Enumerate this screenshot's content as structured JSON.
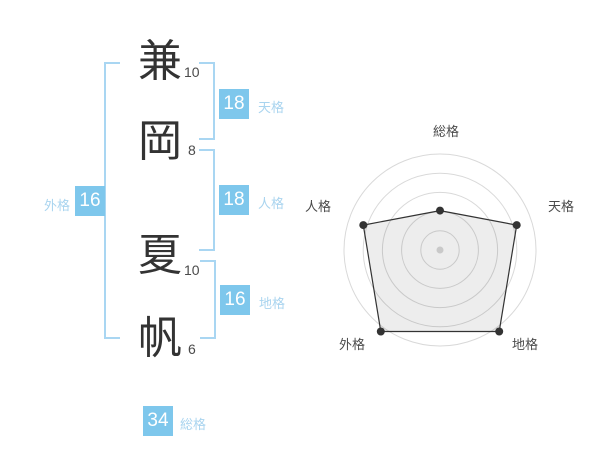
{
  "title": "姓名判断の画数と五格",
  "name": {
    "chars": [
      {
        "char": "兼",
        "strokes": "10"
      },
      {
        "char": "岡",
        "strokes": "8"
      },
      {
        "char": "夏",
        "strokes": "10"
      },
      {
        "char": "帆",
        "strokes": "6"
      }
    ]
  },
  "kaku": {
    "tenkaku": {
      "label": "天格",
      "value": "18"
    },
    "jinkaku": {
      "label": "人格",
      "value": "18"
    },
    "chikaku": {
      "label": "地格",
      "value": "16"
    },
    "gaikaku": {
      "label": "外格",
      "value": "16"
    },
    "soukaku": {
      "label": "総格",
      "value": "34"
    }
  },
  "colors": {
    "badge_blue": "#7ec7ec",
    "label_blue": "#a9d4ef",
    "bracket_blue": "#a9d6f2",
    "ring_gray": "#d9d9d9",
    "polygon_line": "#333333",
    "text_dark": "#333333",
    "text_gray": "#4a4a4a"
  },
  "chart_data": {
    "type": "radar",
    "rings": 5,
    "grid": true,
    "legend": false,
    "axes": [
      {
        "label": "総格",
        "value": 34,
        "radius_fraction": 0.41
      },
      {
        "label": "天格",
        "value": 18,
        "radius_fraction": 0.84
      },
      {
        "label": "地格",
        "value": 16,
        "radius_fraction": 1.05
      },
      {
        "label": "外格",
        "value": 16,
        "radius_fraction": 1.05
      },
      {
        "label": "人格",
        "value": 18,
        "radius_fraction": 0.84
      }
    ]
  }
}
